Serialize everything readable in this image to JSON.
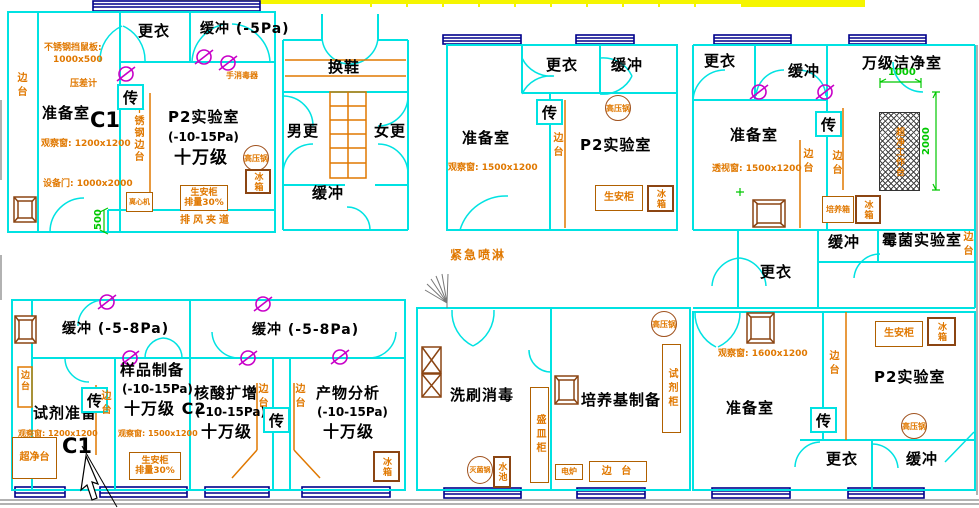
{
  "colors": {
    "wall": "#00E2E2",
    "annotation": "#E07800",
    "equipment": "#8B4513",
    "window_frame": "#00008B",
    "dimension": "#00C800",
    "interlock_symbol": "#C800C8",
    "highlight_strip": "#F5F500",
    "room_text": "#000000"
  },
  "zones": {
    "tl": {
      "dressing": "更衣",
      "buffer": "缓冲 (-5Pa)",
      "rat_guard": "不锈钢挡鼠板:",
      "rat_guard_size": "1000x500",
      "pressure_gauge": "压差计",
      "prep": "准备室",
      "code": "C1",
      "window": "观察窗: 1200x1200",
      "equip_door": "设备门: 1000x2000",
      "side_bench": "边台",
      "ss_side_bench": "不锈钢边台",
      "centrifuge": "离心机",
      "lab": "P2实验室",
      "lab_pa": "(-10-15Pa)",
      "lab_class": "十万级",
      "hand_sanitizer": "手消毒器",
      "transfer": "传",
      "autoclave": "高压锅",
      "fridge": "冰箱",
      "bsc": "生安柜",
      "bsc_sub": "排量30%",
      "exhaust": "排风夹道",
      "dim500": "500"
    },
    "tc": {
      "shoe": "换鞋",
      "male": "男更",
      "female": "女更",
      "buffer": "缓冲"
    },
    "tm": {
      "prep": "准备室",
      "window": "观察窗: 1500x1200",
      "dressing": "更衣",
      "buffer": "缓冲",
      "transfer": "传",
      "side_bench": "边台",
      "autoclave": "高压锅",
      "bsc": "生安柜",
      "fridge": "冰箱",
      "lab": "P2实验室"
    },
    "tr": {
      "dressing": "更衣",
      "buffer": "缓冲",
      "clean_room": "万级洁净室",
      "dim1000": "1000",
      "dim2000": "2000",
      "prep": "准备室",
      "window": "透视窗: 1500x1200",
      "transfer": "传",
      "side_bench": "边台",
      "side_bench2": "边台",
      "clean_bench": "超净工作台",
      "incubator": "培养箱",
      "fridge": "冰箱",
      "side_bench_right": "边台"
    },
    "mr": {
      "buffer": "缓冲",
      "mold_lab": "霉菌实验室",
      "dressing": "更衣"
    },
    "mid": {
      "shower": "紧急喷淋"
    },
    "bl": {
      "buffer": "缓冲 (-5-8Pa)",
      "reagent": "试剂准备",
      "code": "C1",
      "window1": "观察窗: 1200x1200",
      "clean_bench": "超净台",
      "side_bench": "边台",
      "transfer": "传",
      "side_bench2": "边台",
      "sample": "样品制备",
      "sample_pa": "(-10-15Pa)",
      "sample_class": "十万级 C2",
      "window2": "观察窗: 1500x1200",
      "bsc": "生安柜",
      "bsc_sub": "排量30%"
    },
    "bc": {
      "buffer": "缓冲 (-5-8Pa)",
      "nucleic": "核酸扩增",
      "nucleic_pa": "(-10-15Pa)",
      "nucleic_class": "十万级",
      "side_bench1": "边台",
      "transfer": "传",
      "side_bench2": "边台",
      "product": "产物分析",
      "product_pa": "(-10-15Pa)",
      "product_class": "十万级",
      "fridge": "冰箱"
    },
    "bw": {
      "wash": "洗刷消毒",
      "dish_cabinet": "盛皿柜",
      "sterilizer": "灭菌锅",
      "sink": "水池"
    },
    "bm": {
      "media": "培养基制备",
      "autoclave": "高压锅",
      "reagent_cabinet": "试剂柜",
      "stove": "电炉",
      "side_bench": "边 台"
    },
    "br": {
      "window": "观察窗: 1600x1200",
      "prep": "准备室",
      "transfer": "传",
      "side_bench": "边台",
      "lab": "P2实验室",
      "bsc": "生安柜",
      "fridge": "冰箱",
      "autoclave": "高压锅",
      "dressing": "更衣",
      "buffer": "缓冲"
    }
  }
}
